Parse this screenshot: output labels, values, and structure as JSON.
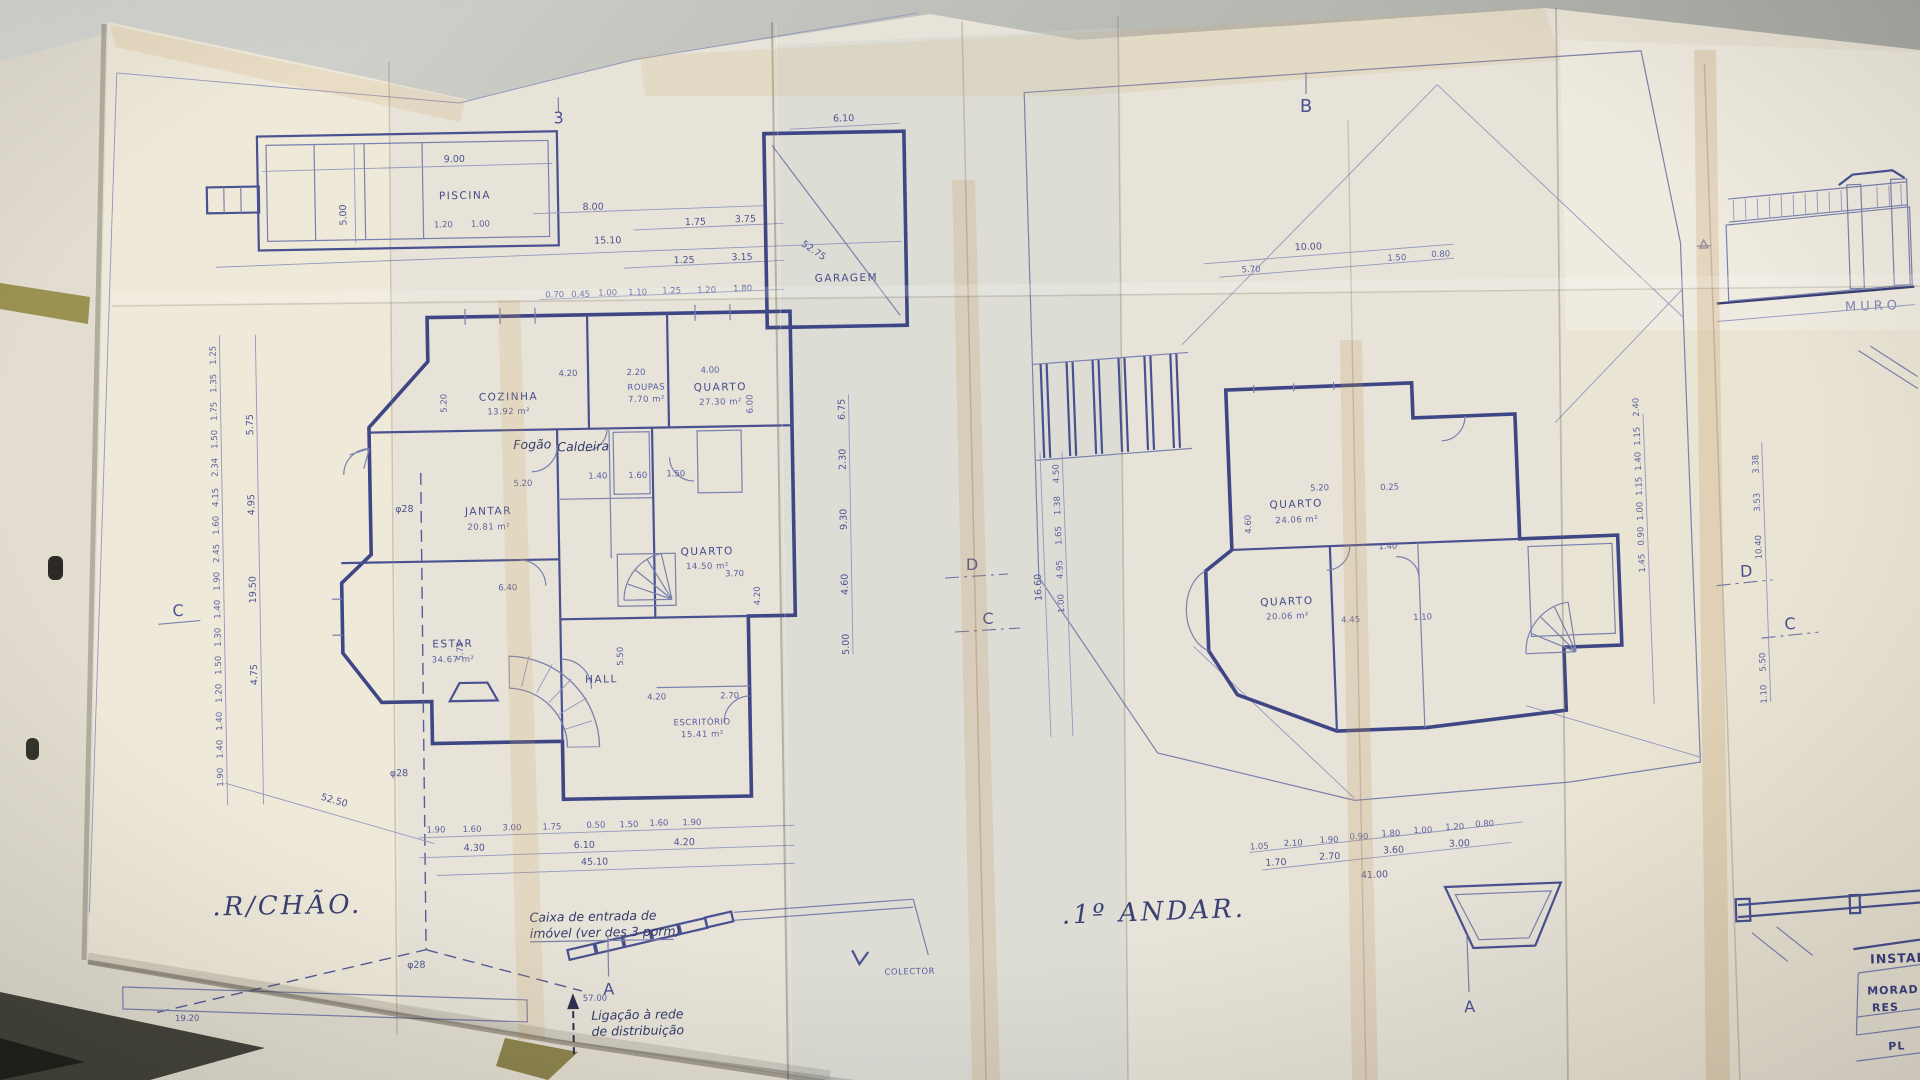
{
  "photo": {
    "grid_marker_3": "3",
    "grid_marker_b": "B",
    "section_c": "C",
    "section_d": "D",
    "section_a": "A"
  },
  "ground_floor": {
    "title": ".R/CHÃO.",
    "rooms": {
      "piscina": "PISCINA",
      "garagem": "GARAGEM",
      "cozinha": "COZINHA",
      "cozinha_area": "13.92 m²",
      "roupas": "ROUPAS",
      "roupas_area": "7.70 m²",
      "quarto1": "QUARTO",
      "quarto1_area": "27.30 m²",
      "jantar": "JANTAR",
      "jantar_area": "20.81 m²",
      "quarto2": "QUARTO",
      "quarto2_area": "14.50 m²",
      "estar": "ESTAR",
      "estar_area": "34.67 m²",
      "hall": "HALL",
      "escritorio": "ESCRITÓRIO",
      "escritorio_area": "15.41 m²",
      "fogao": "Fogão",
      "caldeira": "Caldeira"
    },
    "notes": {
      "caixa_l1": "Caixa de entrada de",
      "caixa_l2": "imóvel (ver des 3 porm)",
      "ligacao_l1": "Ligação à rede",
      "ligacao_l2": "de distribuição",
      "colector": "COLECTOR",
      "phi28": "φ28"
    },
    "dims": {
      "pool_len": "9.00",
      "pool_wid": "5.00",
      "pool_s1": "1.20",
      "pool_s2": "1.00",
      "pool_d1": "8.00",
      "pool_d2": "15.10",
      "garage_w": "6.10",
      "diag_g": "52.75",
      "top_a": [
        "1.75",
        "3.75"
      ],
      "top_b": [
        "1.25",
        "3.15"
      ],
      "top_c": [
        "0.70",
        "0.45",
        "1.00",
        "1.10",
        "1.25",
        "1.20",
        "1.80"
      ],
      "left_a": [
        "1.25",
        "1.35",
        "1.75",
        "1.50",
        "2.34",
        "4.15",
        "1.60",
        "2.45",
        "1.90",
        "1.40",
        "1.30",
        "1.50",
        "1.20",
        "1.40",
        "1.40",
        "1.90"
      ],
      "left_b": [
        "5.75",
        "4.95",
        "19.50",
        "4.75"
      ],
      "right_a": [
        "6.75",
        "2.30",
        "9.30",
        "4.60",
        "5.00"
      ],
      "inner": [
        "4.20",
        "2.20",
        "4.00",
        "5.20",
        "6.00",
        "1.40",
        "1.60",
        "1.50",
        "5.20",
        "6.40",
        "5.75",
        "5.50",
        "4.20",
        "2.70",
        "3.70",
        "4.20"
      ],
      "bottom_a": [
        "1.90",
        "1.60",
        "3.00",
        "1.75",
        "0.50",
        "1.50",
        "1.60",
        "1.90"
      ],
      "bottom_b": [
        "4.30",
        "6.10",
        "4.20"
      ],
      "bottom_total": "45.10",
      "diag_total": "52.50",
      "street": "57.00",
      "wall": "19.20"
    }
  },
  "first_floor": {
    "title": ".1º ANDAR.",
    "rooms": {
      "quarto1": "QUARTO",
      "quarto1_area": "24.06 m²",
      "quarto2": "QUARTO",
      "quarto2_area": "20.06 m²"
    },
    "dims": {
      "top_total": "10.00",
      "top_row": [
        "5.70",
        "1.50",
        "0.80"
      ],
      "left_a": [
        "4.50",
        "1.38",
        "1.65",
        "4.95",
        "1.00"
      ],
      "left_total": "16.60",
      "right_a": [
        "1.15",
        "1.40",
        "1.15",
        "1.00",
        "0.90",
        "1.45"
      ],
      "right_b": [
        "2.40",
        "3.38",
        "3.53",
        "10.40",
        "5.50",
        "1.10"
      ],
      "inner": [
        "5.20",
        "0.25",
        "4.60",
        "1.40",
        "4.45",
        "1.10"
      ],
      "bottom_a": [
        "1.05",
        "2.10",
        "1.90",
        "0.90",
        "1.80",
        "1.00",
        "1.20",
        "0.80"
      ],
      "bottom_b": [
        "1.70",
        "2.70",
        "3.60",
        "3.00"
      ],
      "bottom_total": "41.00"
    }
  },
  "side_panel": {
    "muro": "MURO",
    "title_block": {
      "header": "INSTAL",
      "row1": "MORAD",
      "row2": "RES",
      "row3": "PL"
    }
  }
}
